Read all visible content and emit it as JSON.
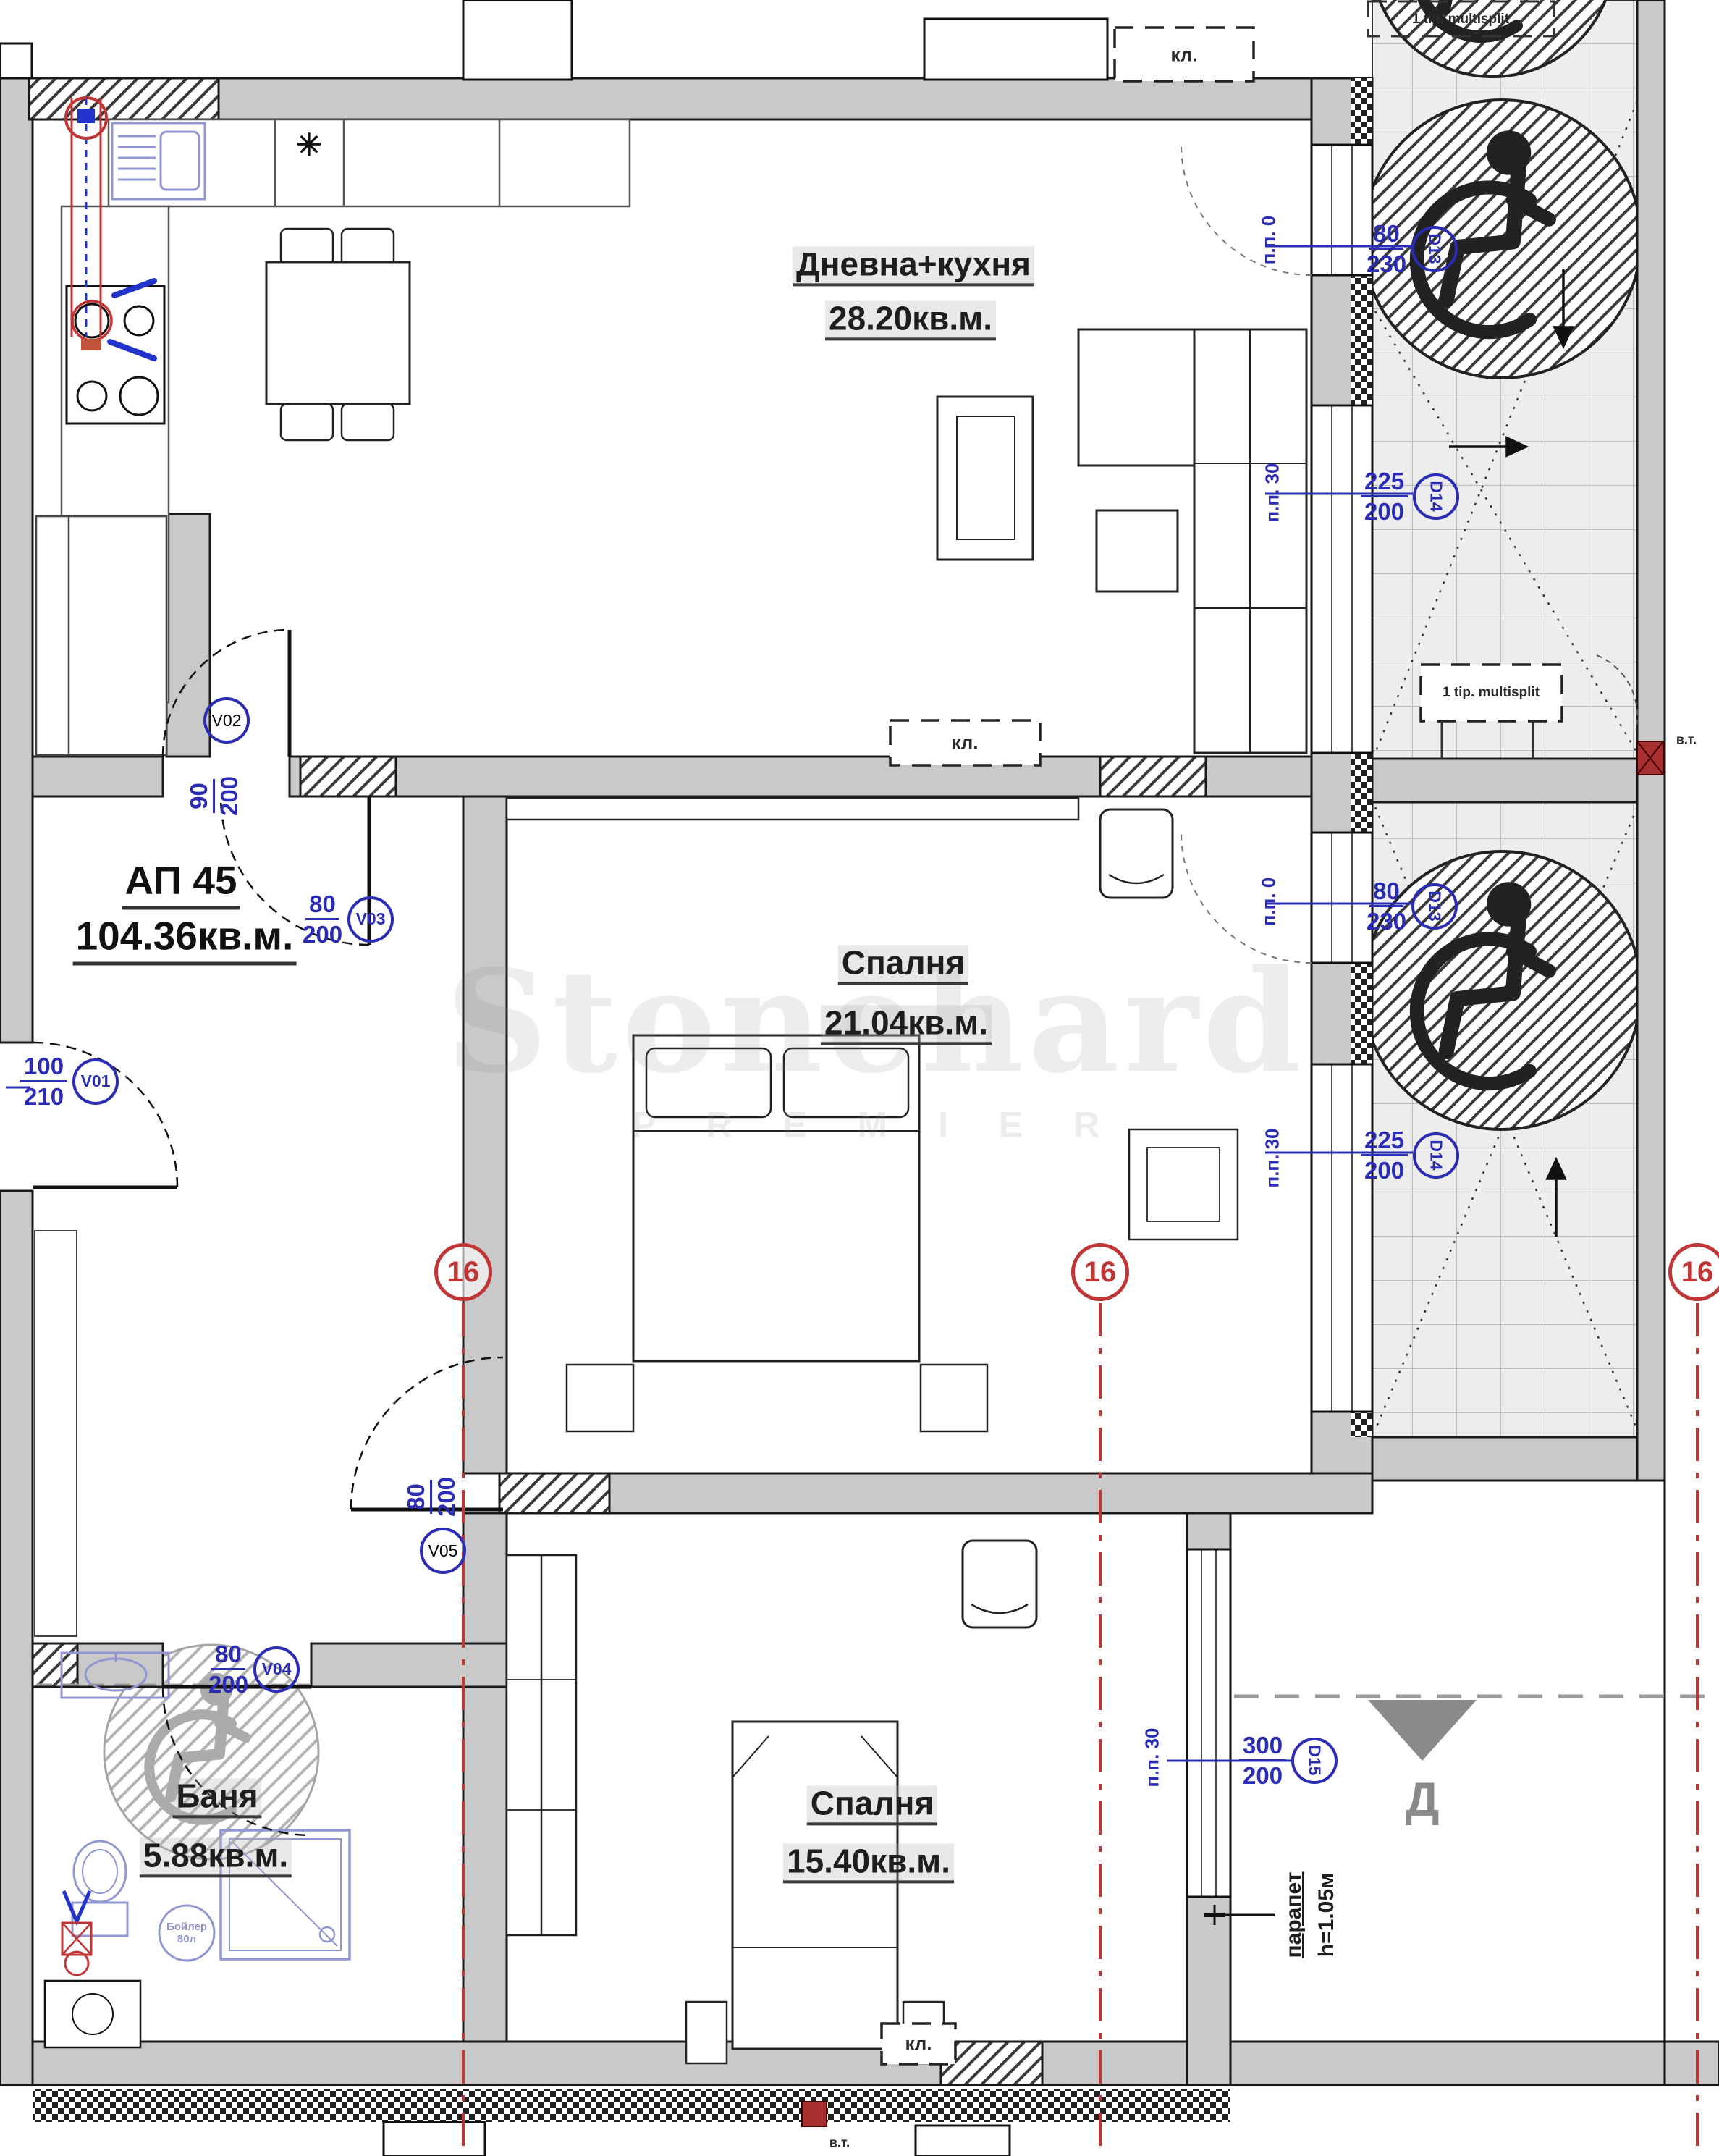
{
  "apartment": {
    "label": "АП 45",
    "area": "104.36кв.м."
  },
  "rooms": [
    {
      "name": "Дневна+кухня",
      "area": "28.20кв.м."
    },
    {
      "name": "Спалня",
      "area": "21.04кв.м."
    },
    {
      "name": "Спалня",
      "area": "15.40кв.м."
    },
    {
      "name": "Баня",
      "area": "5.88кв.м."
    }
  ],
  "openings": {
    "entrance": {
      "top": "100",
      "bottom": "210",
      "tag": "V01"
    },
    "living_door": {
      "top": "90",
      "bottom": "200",
      "tag": "V02"
    },
    "bedroom1_door": {
      "top": "80",
      "bottom": "200",
      "tag": "V03"
    },
    "bathroom_door": {
      "top": "80",
      "bottom": "200",
      "tag": "V04"
    },
    "bedroom2_door": {
      "top": "80",
      "bottom": "200",
      "tag": "V05"
    },
    "balcony_door1": {
      "top": "80",
      "bottom": "230",
      "tag": "D13"
    },
    "balcony_window1": {
      "top": "225",
      "bottom": "200",
      "tag": "D14"
    },
    "balcony_door2": {
      "top": "80",
      "bottom": "230",
      "tag": "D13"
    },
    "balcony_window2": {
      "top": "225",
      "bottom": "200",
      "tag": "D14"
    },
    "bedroom2_window": {
      "top": "300",
      "bottom": "200",
      "tag": "D15"
    }
  },
  "sill_labels": {
    "pp0": "п.п. 0",
    "pp30": "п.п. 30"
  },
  "annotations": {
    "multisplit": "1 tip. multisplit",
    "ac_unit": "кл.",
    "water_point": "в.т.",
    "parapet_line1": "парапет",
    "parapet_line2": "h=1.05м",
    "direction_letter": "Д",
    "boiler_line1": "Бойлер",
    "boiler_line2": "80л",
    "kitchen_star": "✳",
    "section_number": "16"
  },
  "watermark": {
    "line1": "Stonehard",
    "line2": "P R E M I E R"
  },
  "colors": {
    "wall": "#c9c9c9",
    "line": "#1a1a1a",
    "dimension_blue": "#2a2cb4",
    "fixture_blue": "#9096cf",
    "section_red": "#c03535",
    "tile_bg": "#ededed",
    "tile_line": "#bdbdbd"
  }
}
